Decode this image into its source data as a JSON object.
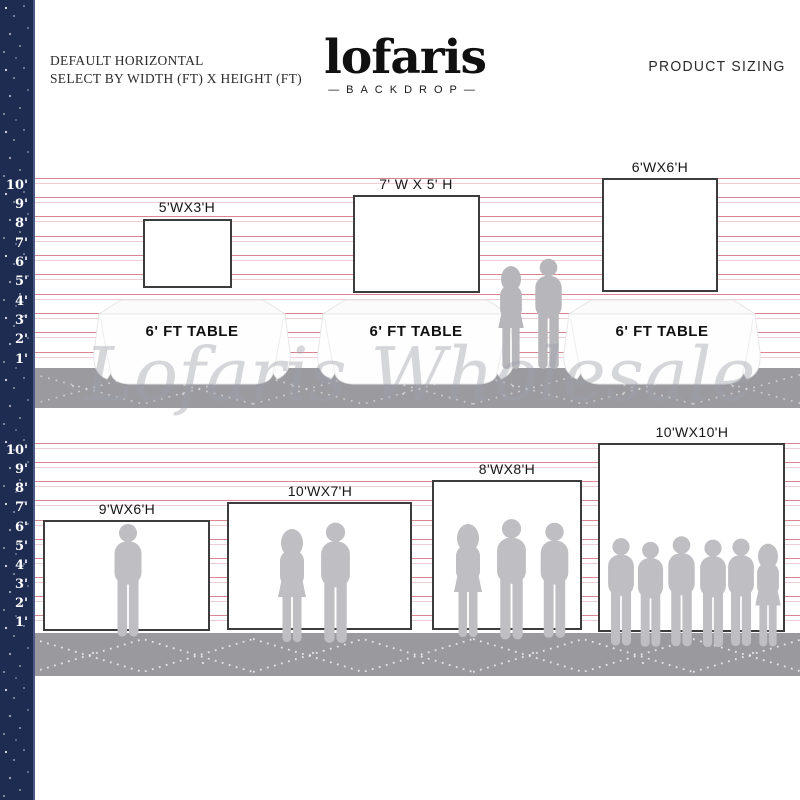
{
  "header": {
    "subtitle_line1": "DEFAULT HORIZONTAL",
    "subtitle_line2": "SELECT BY WIDTH (FT) X HEIGHT (FT)",
    "logo": "lofaris",
    "logo_dash_left": "—",
    "logo_sub": "BACKDROP",
    "logo_dash_right": "—",
    "product_sizing": "PRODUCT SIZING"
  },
  "ruler": {
    "labels": [
      "10'",
      "9'",
      "8'",
      "7'",
      "6'",
      "5'",
      "4'",
      "3'",
      "2'",
      "1'"
    ],
    "unit": "ft"
  },
  "top_row": {
    "backdrops": [
      {
        "size_label": "5'WX3'H",
        "table_label": "6' FT TABLE"
      },
      {
        "size_label": "7' W X 5' H",
        "table_label": "6' FT TABLE"
      },
      {
        "size_label": "6'WX6'H",
        "table_label": "6' FT TABLE"
      }
    ]
  },
  "bottom_row": {
    "backdrops": [
      {
        "size_label": "9'WX6'H",
        "people_count": 1
      },
      {
        "size_label": "10'WX7'H",
        "people_count": 2
      },
      {
        "size_label": "8'WX8'H",
        "people_count": 3
      },
      {
        "size_label": "10'WX10'H",
        "people_count": 6
      }
    ]
  },
  "watermark": "Lofaris Wholesale",
  "colors": {
    "navy_strip": "#1f2c52",
    "foot_line_red": "#d4707f",
    "foot_line_pink": "#f0ccd4",
    "floor_gray": "#9b9a9f",
    "silhouette_gray": "#bfbfc3",
    "backdrop_border": "#3c3c3c",
    "watermark_gray": "#9fa0ab"
  }
}
